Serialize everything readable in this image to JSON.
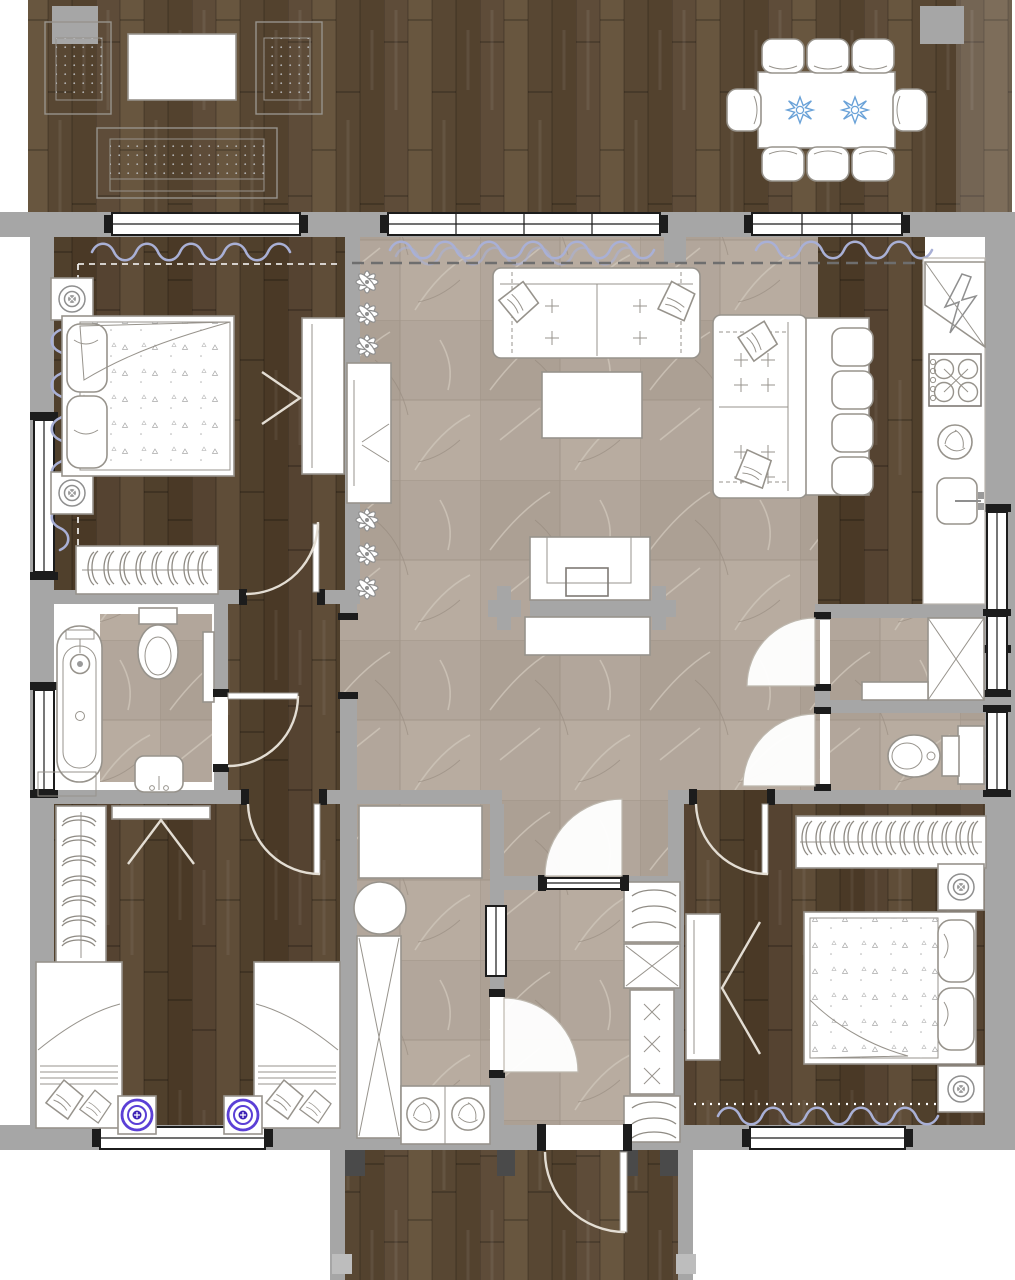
{
  "document": {
    "kind": "architectural floor plan",
    "view": "top-down 2D rendered plan",
    "building": "single-storey log house with terrace and porch",
    "visible_text": "none"
  },
  "palette": {
    "wall": "#a6a6a6",
    "wall_line": "#8d8d8d",
    "frame": "#1c1c1c",
    "furn_stroke": "#97938c",
    "curtain": "#a9b0d6",
    "dash": "#6e6e6e",
    "lamp_purple": "#5b3fd6",
    "lamp_purple_core": "#3d22b5",
    "decor_blue": "#6aa2d8",
    "plant": "#8f8f8f",
    "wood_a1": "#5e4c39",
    "wood_a2": "#53422e",
    "wood_a3": "#68563f",
    "wood_a4": "#584733",
    "wood_b1": "#554331",
    "wood_b2": "#4a3926",
    "wood_b3": "#5f4d38",
    "wood_b4": "#50402c",
    "tile_base": "#b2a69b",
    "tile_alt": "#aca094",
    "tile_alt2": "#b8aca0",
    "tile_vein": "#cdc3b7",
    "tile_grout": "#9c9084",
    "post_dark": "#4a4a4a",
    "post_light": "#bdbdbd",
    "arc": "#e3ddd3",
    "sector_stroke": "#bdb7ad"
  },
  "floors": {
    "terrace": "dark wood deck planks",
    "bedrooms": "dark wood planks",
    "living_hall": "beige stone tile",
    "bathroom_wc_utility": "beige stone tile",
    "porch": "dark wood deck planks"
  },
  "areas": [
    {
      "id": "terrace",
      "furniture": [
        "wicker armchair x2",
        "side table",
        "wicker bench",
        "outdoor dining table",
        "dining chairs x8",
        "blue decor plates x2"
      ]
    },
    {
      "id": "bedroom-master",
      "furniture": [
        "double bed",
        "nightstand with lamp x2",
        "wardrobe",
        "open clothes rack",
        "window curtains"
      ]
    },
    {
      "id": "living-room",
      "furniture": [
        "three-seat sofa with pillows",
        "coffee table",
        "double-sided media wall with TV",
        "plant row",
        "console panel"
      ]
    },
    {
      "id": "dining-kitchen",
      "furniture": [
        "two-seat sofa",
        "dining table",
        "chairs x4",
        "fridge corner unit",
        "stove 4-burner",
        "dishwasher",
        "sink",
        "counter run"
      ]
    },
    {
      "id": "bathroom",
      "furniture": [
        "oval bathtub",
        "toilet",
        "washbasin",
        "bath mat",
        "shelf"
      ]
    },
    {
      "id": "utility-room",
      "furniture": [
        "counter",
        "laundry basket",
        "tall ironing cabinet",
        "washing machine x2"
      ]
    },
    {
      "id": "entry-hall",
      "furniture": [
        "coat hangers",
        "shoe shelf with boxes",
        "interior glazed door",
        "front door"
      ]
    },
    {
      "id": "storage-room",
      "furniture": [
        "storage box",
        "shelf"
      ]
    },
    {
      "id": "wc",
      "furniture": [
        "toilet",
        "cabinet"
      ]
    },
    {
      "id": "bedroom-kids",
      "furniture": [
        "single bed x2",
        "nightstand with purple lamp x2",
        "hanger closet",
        "wardrobe"
      ]
    },
    {
      "id": "bedroom-second",
      "furniture": [
        "double bed",
        "nightstand with lamp x2",
        "open hanger closet",
        "wardrobe"
      ]
    },
    {
      "id": "porch",
      "furniture": [
        "entrance door",
        "timber posts"
      ]
    }
  ],
  "openings": {
    "exterior_windows": 10,
    "interior_doors": 8,
    "entrance_doors": 1,
    "terrace_slider_panes": 4
  }
}
